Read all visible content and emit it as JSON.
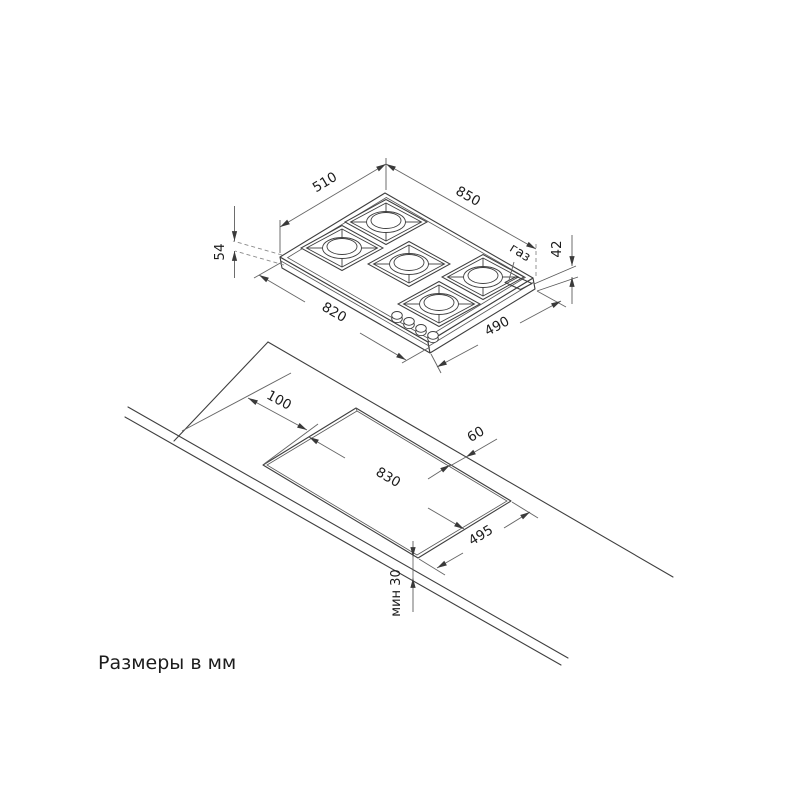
{
  "note": "Размеры в мм",
  "hob_view": {
    "gas_label": "газ",
    "dims": {
      "top_width": "510",
      "top_length": "850",
      "total_height": "54",
      "body_height": "42",
      "bottom_length": "820",
      "bottom_width": "490"
    },
    "burner_count": 5,
    "knob_count": 4
  },
  "installation_view": {
    "dims": {
      "left_offset": "100",
      "back_offset": "60",
      "cutout_length": "830",
      "cutout_width": "495",
      "front_min_offset": "мин 30"
    }
  },
  "colors": {
    "background": "#ffffff",
    "outline": "#3f3f3f",
    "dimension": "#666666",
    "text": "#1c1c1c"
  }
}
